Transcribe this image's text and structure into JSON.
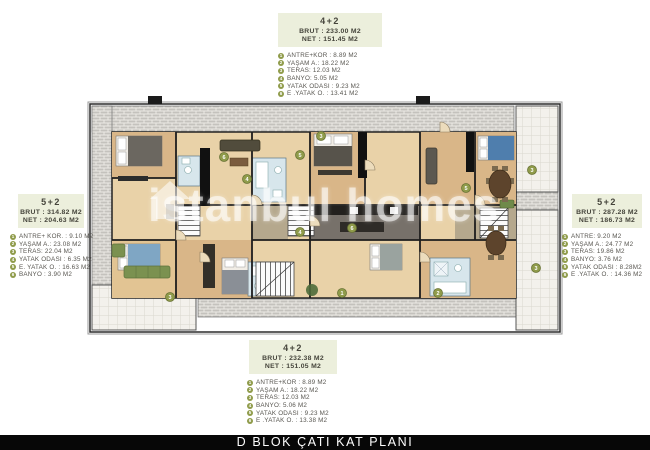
{
  "title_bar": {
    "label": "D BLOK ÇATI KAT PLANI"
  },
  "watermark": {
    "label": "istanbul homes"
  },
  "units": {
    "top": {
      "type_label": "4+2",
      "brut": "BRUT : 233.00 M2",
      "net": "NET :  151.45 M2",
      "rooms": [
        {
          "num": "1",
          "label": "ANTRE+KOR : 8.89 M2"
        },
        {
          "num": "2",
          "label": "YAŞAM A.: 18.22 M2"
        },
        {
          "num": "3",
          "label": "TERAS: 12.03 M2"
        },
        {
          "num": "4",
          "label": "BANYO: 5.05 M2"
        },
        {
          "num": "5",
          "label": "YATAK ODASI : 9.23 M2"
        },
        {
          "num": "6",
          "label": "E .YATAK O. : 13.41 M2"
        }
      ]
    },
    "left": {
      "type_label": "5+2",
      "brut": "BRUT : 314.82 M2",
      "net": "NET : 204.63 M2",
      "rooms": [
        {
          "num": "1",
          "label": "ANTRE+ KOR. : 9.10 M2"
        },
        {
          "num": "2",
          "label": "YAŞAM A.: 23.08 M2"
        },
        {
          "num": "3",
          "label": "TERAS: 22.04 M2"
        },
        {
          "num": "4",
          "label": "YATAK ODASI : 6.35 M2"
        },
        {
          "num": "5",
          "label": "E. YATAK O. : 16.63 M2"
        },
        {
          "num": "6",
          "label": "BANYO : 3.90 M2"
        }
      ]
    },
    "right": {
      "type_label": "5+2",
      "brut": "BRUT : 287.28 M2",
      "net": "NET : 186.73 M2",
      "rooms": [
        {
          "num": "1",
          "label": "ANTRE: 9.20 M2"
        },
        {
          "num": "2",
          "label": "YAŞAM A.: 24.77 M2"
        },
        {
          "num": "3",
          "label": "TERAS: 19.86 M2"
        },
        {
          "num": "4",
          "label": "BANYO: 3.76 M2"
        },
        {
          "num": "5",
          "label": "YATAK ODASI : 8.28M2"
        },
        {
          "num": "6",
          "label": "E .YATAK O. : 14.36 M2"
        }
      ]
    },
    "bottom": {
      "type_label": "4+2",
      "brut": "BRUT : 232.38 M2",
      "net": "NET : 151.05 M2",
      "rooms": [
        {
          "num": "1",
          "label": "ANTRE+KOR : 8.89 M2"
        },
        {
          "num": "2",
          "label": "YAŞAM A.: 18.22 M2"
        },
        {
          "num": "3",
          "label": "TERAS: 12.03 M2"
        },
        {
          "num": "4",
          "label": "BANYO: 5.06 M2"
        },
        {
          "num": "5",
          "label": "YATAK ODASI : 9.23 M2"
        },
        {
          "num": "6",
          "label": "E .YATAK O. : 13.38 M2"
        }
      ]
    }
  },
  "plan": {
    "markers": [
      {
        "n": "3"
      },
      {
        "n": "3"
      },
      {
        "n": "3"
      },
      {
        "n": "3"
      },
      {
        "n": "6"
      },
      {
        "n": "4"
      },
      {
        "n": "5"
      },
      {
        "n": "5"
      },
      {
        "n": "6"
      },
      {
        "n": "4"
      },
      {
        "n": "1"
      },
      {
        "n": "2"
      }
    ],
    "colors": {
      "card_bg": "#ecefdc",
      "marker_green": "#8f9b4a",
      "wood": "#d9b688",
      "wood_light": "#e9d2a8",
      "bath_blue": "#d7e6ec",
      "wall": "#1d1d1d",
      "title_bg": "#070707"
    }
  }
}
